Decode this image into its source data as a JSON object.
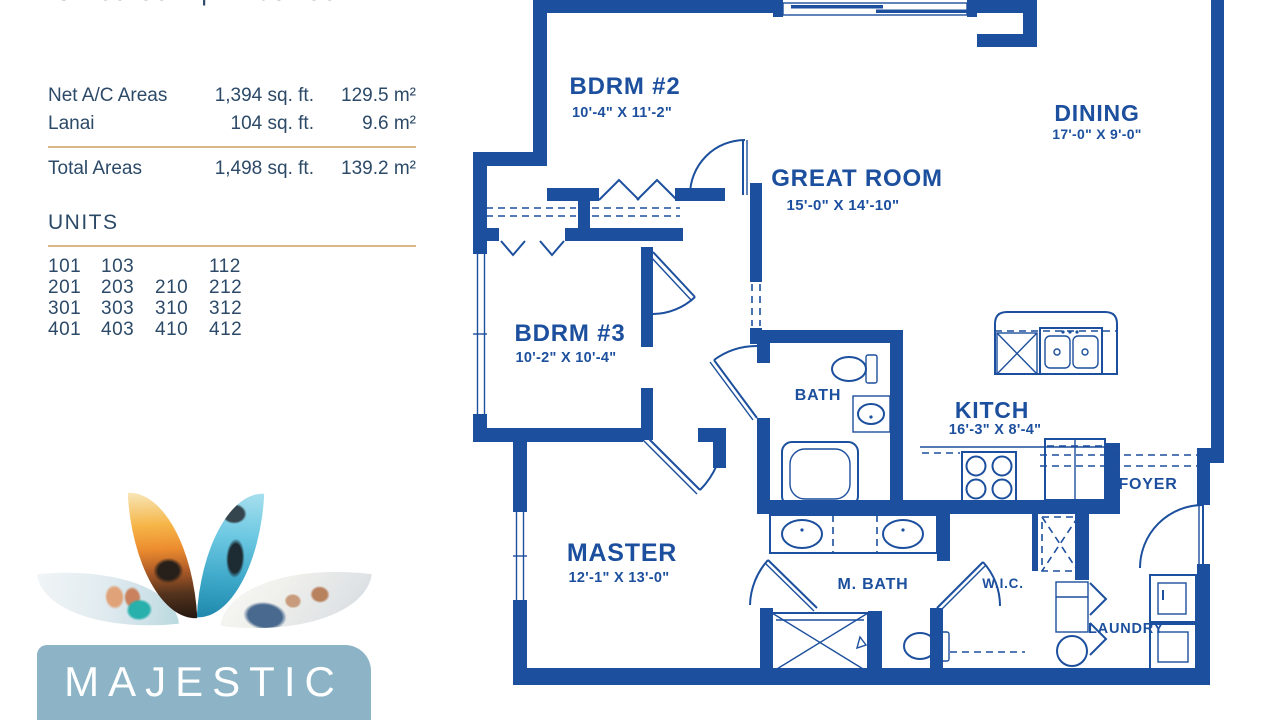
{
  "colors": {
    "ink": "#2c4a68",
    "wall": "#1c4f9d",
    "tan": "#d8b788",
    "brand": "#8cb4c6"
  },
  "header": {
    "subtitle": "3 Bedroom | 2 Bathroom"
  },
  "areas_table": {
    "rows": [
      {
        "label": "Net A/C Areas",
        "sqft": "1,394 sq. ft.",
        "sqm": "129.5 m²"
      },
      {
        "label": "Lanai",
        "sqft": "104 sq. ft.",
        "sqm": "9.6 m²"
      }
    ],
    "total": {
      "label": "Total Areas",
      "sqft": "1,498 sq. ft.",
      "sqm": "139.2 m²"
    }
  },
  "units": {
    "heading": "UNITS",
    "rows": [
      [
        "101",
        "103",
        "",
        "112"
      ],
      [
        "201",
        "203",
        "210",
        "212"
      ],
      [
        "301",
        "303",
        "310",
        "312"
      ],
      [
        "401",
        "403",
        "410",
        "412"
      ]
    ]
  },
  "logo": {
    "name": "MAJESTIC"
  },
  "floorplan": {
    "rooms": [
      {
        "name": "BDRM #2",
        "dims": "10'-4\" X 11'-2\""
      },
      {
        "name": "DINING",
        "dims": "17'-0\" X 9'-0\""
      },
      {
        "name": "GREAT ROOM",
        "dims": "15'-0\" X 14'-10\""
      },
      {
        "name": "BDRM #3",
        "dims": "10'-2\" X 10'-4\""
      },
      {
        "name": "BATH",
        "dims": ""
      },
      {
        "name": "KITCH",
        "dims": "16'-3\" X 8'-4\""
      },
      {
        "name": "FOYER",
        "dims": ""
      },
      {
        "name": "MASTER",
        "dims": "12'-1\" X 13'-0\""
      },
      {
        "name": "M. BATH",
        "dims": ""
      },
      {
        "name": "W.I.C.",
        "dims": ""
      },
      {
        "name": "LAUNDRY",
        "dims": ""
      }
    ],
    "fixtures": [
      "sliding-glass-door",
      "kitchen-island-double-sink",
      "dishwasher",
      "range-4-burner",
      "refrigerator",
      "bathtub",
      "toilet",
      "vanity-sink",
      "double-vanity",
      "walk-in-shower",
      "washer",
      "dryer",
      "laundry-tub",
      "linen-closet",
      "bifold-closet-doors"
    ]
  }
}
